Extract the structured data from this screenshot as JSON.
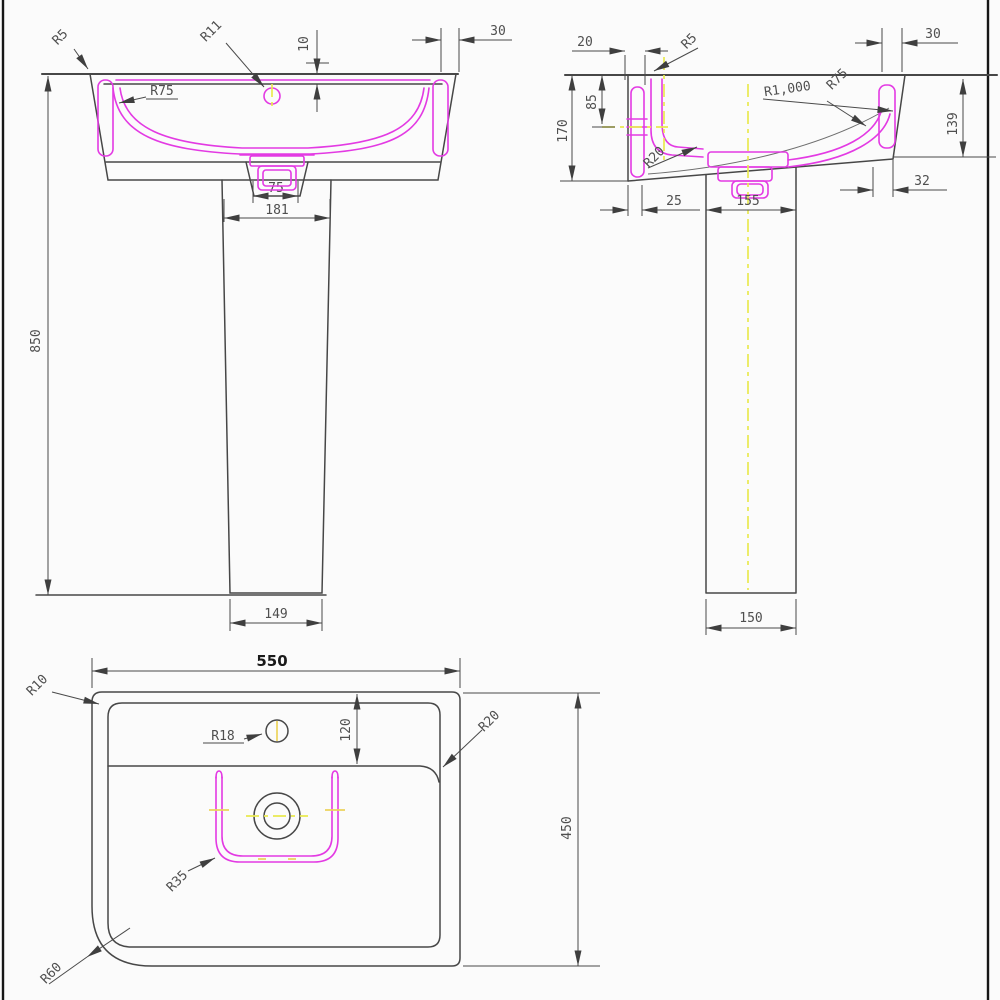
{
  "drawing": {
    "type": "pedestal-basin-technical-drawing",
    "colors": {
      "line": "#474747",
      "profile_magenta": "#e33ae3",
      "centerline_yellow": "#e9e950",
      "dimension_text": "#4f4f4f",
      "bold_text": "#1a1a1a",
      "background": "#fbfbfb",
      "border": "#161616"
    },
    "views": {
      "front": {
        "labels": {
          "r5": "R5",
          "r11": "R11",
          "r75": "R75",
          "d10": "10",
          "d30": "30",
          "d75": "75",
          "d181": "181",
          "d850": "850",
          "d149": "149"
        }
      },
      "side": {
        "labels": {
          "d20": "20",
          "r5": "R5",
          "d30": "30",
          "d85": "85",
          "d170": "170",
          "r1000": "R1,000",
          "r75": "R75",
          "d139": "139",
          "r20": "R20",
          "d32": "32",
          "d25": "25",
          "d155": "155",
          "d150": "150"
        }
      },
      "plan": {
        "labels": {
          "d550": "550",
          "r10": "R10",
          "r18": "R18",
          "d120": "120",
          "r20": "R20",
          "d450": "450",
          "r35": "R35",
          "r60": "R60"
        }
      }
    }
  }
}
